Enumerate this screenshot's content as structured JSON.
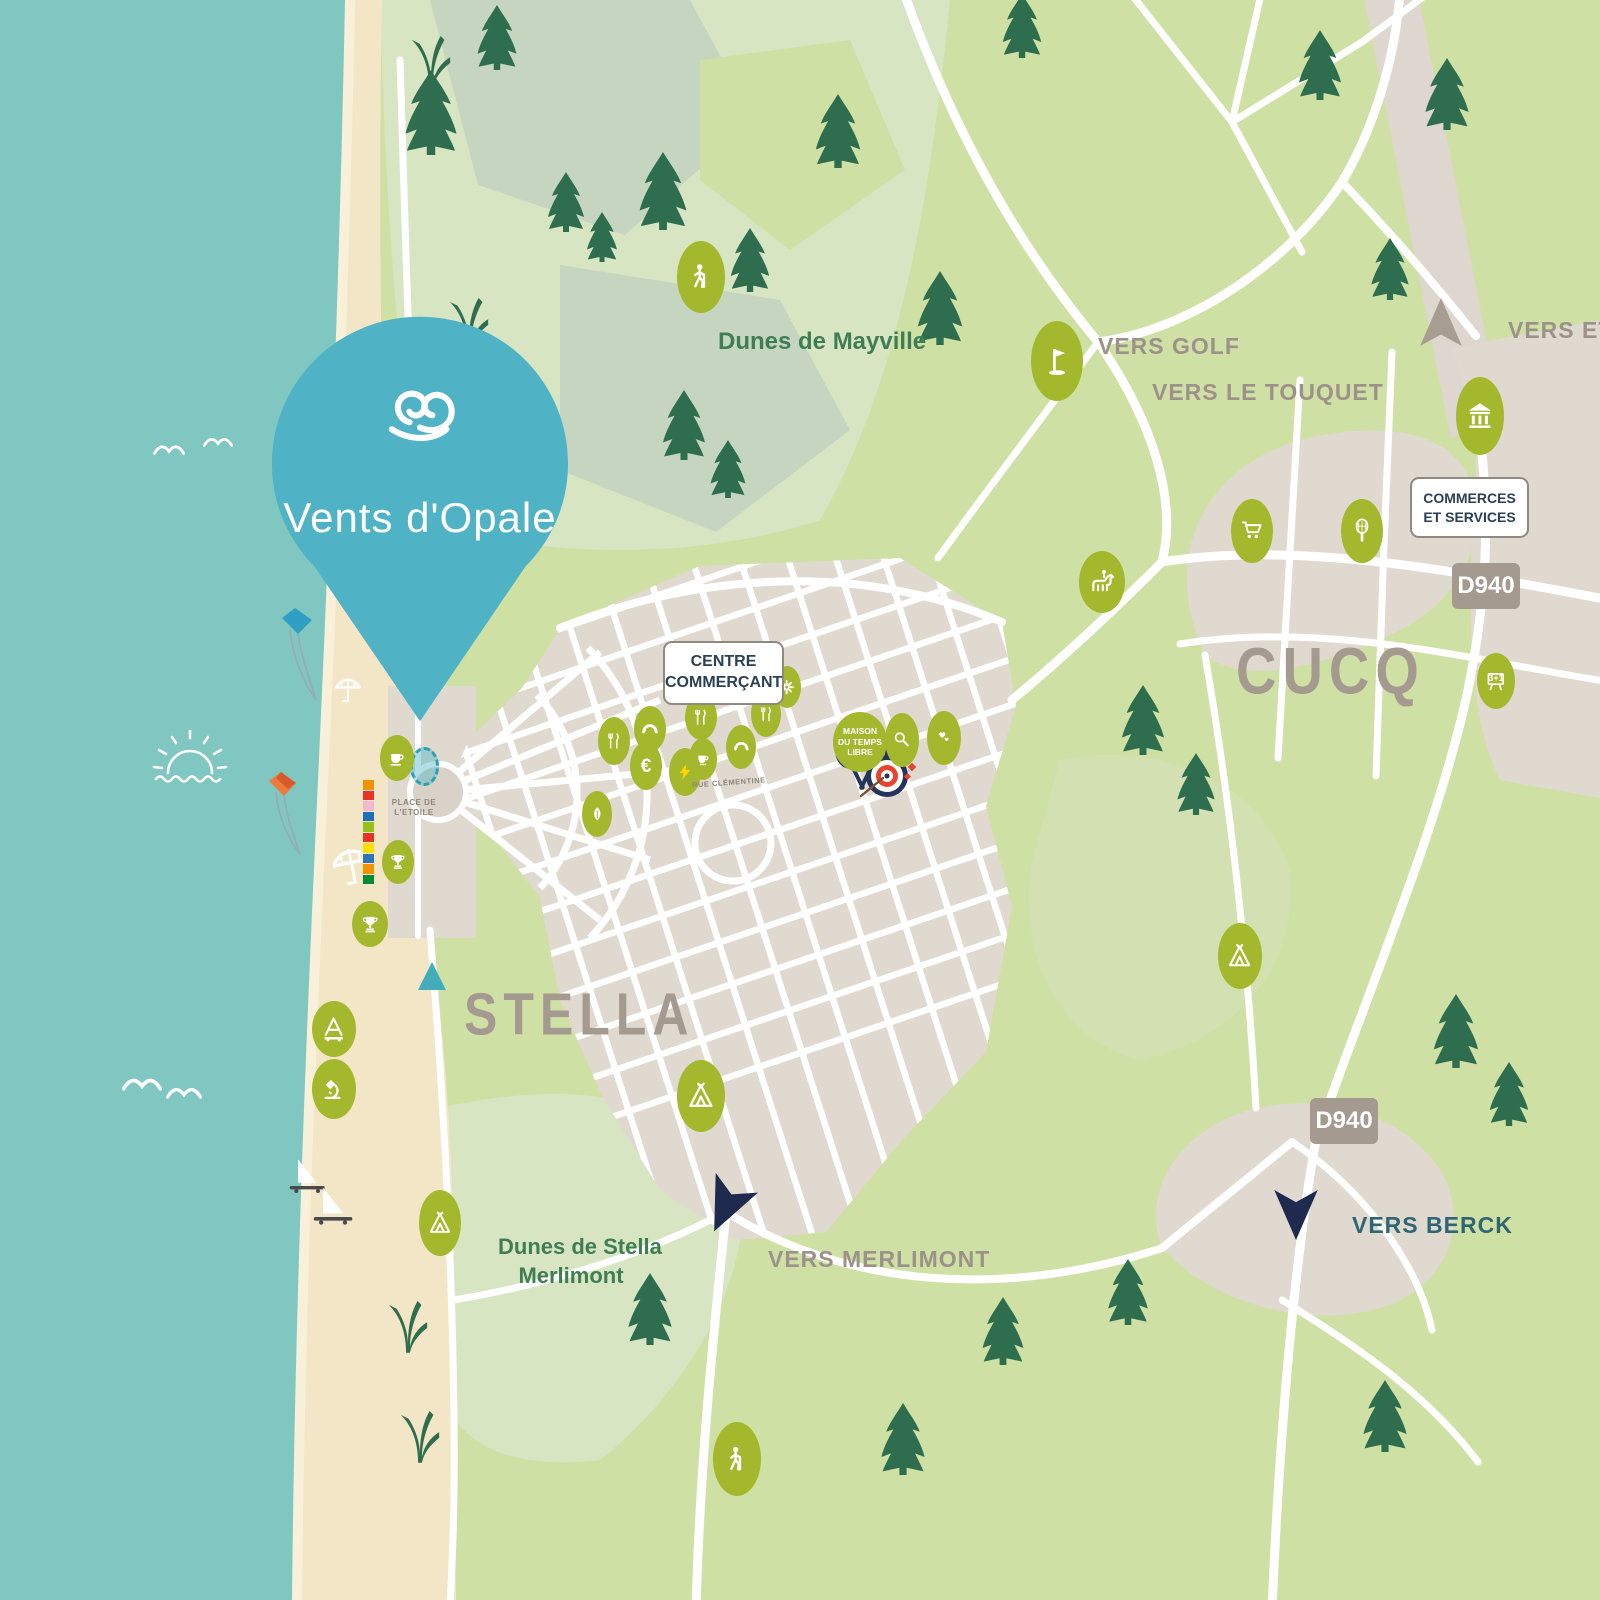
{
  "app": {
    "title": "Vents d'Opale",
    "type": "illustrated-location-map"
  },
  "colors": {
    "sea": "#7fc7c0",
    "sand": "#f3e6c6",
    "land": "#cfe0a5",
    "land_pale": "#d8e5c2",
    "land_sage": "#c5d5c0",
    "urban": "#e0d9d0",
    "road": "#ffffff",
    "olive": "#a3b82d",
    "pine": "#2e6e4e",
    "pin": "#4fb2c5",
    "taupe_text": "#9c928a",
    "navy_text": "#2c4055",
    "green_text": "#3f7d54",
    "teal_text": "#2f6673",
    "road_badge": "#a49a90",
    "arrow_navy": "#1e2b4e"
  },
  "pin": {
    "label": "Vents d'Opale"
  },
  "labels": {
    "cucq": "CUCQ",
    "stella": "STELLA",
    "dunes_mayville": "Dunes de Mayville",
    "dunes_stella_1": "Dunes de Stella",
    "dunes_stella_2": "Merlimont",
    "vers_golf": "VERS GOLF",
    "vers_touquet": "VERS LE TOUQUET",
    "vers_etaples": "VERS ETAPLES",
    "vers_merlimont": "VERS MERLIMONT",
    "vers_berck": "VERS BERCK",
    "centre_1": "CENTRE",
    "centre_2": "COMMERÇANT",
    "commerces_1": "COMMERCES",
    "commerces_2": "ET SERVICES",
    "d940": "D940",
    "maison_1": "MAISON",
    "maison_2": "DU TEMPS",
    "maison_3": "LIBRE",
    "place_etoile_1": "PLACE DE",
    "place_etoile_2": "L'ETOILE",
    "rue_clementine": "RUE CLÉMENTINE"
  },
  "pois": [
    {
      "name": "hiking-poi",
      "icon": "hiker",
      "x": 701,
      "y": 277,
      "w": 48,
      "h": 72
    },
    {
      "name": "golf-poi",
      "icon": "golf",
      "x": 1057,
      "y": 361,
      "w": 52,
      "h": 80
    },
    {
      "name": "monument-poi",
      "icon": "monument",
      "x": 1480,
      "y": 416,
      "w": 48,
      "h": 78
    },
    {
      "name": "supermarket-poi",
      "icon": "cart",
      "x": 1252,
      "y": 531,
      "w": 42,
      "h": 64
    },
    {
      "name": "tennis-poi",
      "icon": "racket",
      "x": 1362,
      "y": 531,
      "w": 42,
      "h": 64
    },
    {
      "name": "equestrian-poi",
      "icon": "horse",
      "x": 1102,
      "y": 582,
      "w": 46,
      "h": 62
    },
    {
      "name": "cafe-poi",
      "icon": "coffee",
      "x": 397,
      "y": 758,
      "w": 34,
      "h": 46
    },
    {
      "name": "club-poi",
      "icon": "trophy",
      "x": 398,
      "y": 862,
      "w": 32,
      "h": 44
    },
    {
      "name": "club-poi",
      "icon": "trophy",
      "x": 370,
      "y": 924,
      "w": 36,
      "h": 46
    },
    {
      "name": "restaurant-poi",
      "icon": "forkknife",
      "x": 614,
      "y": 741,
      "w": 32,
      "h": 48
    },
    {
      "name": "bakery-poi",
      "icon": "croissant",
      "x": 650,
      "y": 729,
      "w": 32,
      "h": 46
    },
    {
      "name": "restaurant-poi",
      "icon": "forkknife",
      "x": 701,
      "y": 717,
      "w": 32,
      "h": 46
    },
    {
      "name": "restaurant-poi",
      "icon": "forkknife",
      "x": 766,
      "y": 714,
      "w": 30,
      "h": 46
    },
    {
      "name": "pharmacy-poi",
      "icon": "flower",
      "x": 787,
      "y": 687,
      "w": 28,
      "h": 42
    },
    {
      "name": "cafe-poi",
      "icon": "coffee",
      "x": 703,
      "y": 759,
      "w": 28,
      "h": 42
    },
    {
      "name": "bakery-poi",
      "icon": "croissant",
      "x": 741,
      "y": 747,
      "w": 30,
      "h": 44
    },
    {
      "name": "market-poi",
      "icon": "euro",
      "glyph": "€",
      "x": 646,
      "y": 766,
      "w": 32,
      "h": 48
    },
    {
      "name": "tabac-poi",
      "icon": "bolt",
      "x": 685,
      "y": 772,
      "w": 32,
      "h": 48
    },
    {
      "name": "park-poi",
      "icon": "leaf",
      "x": 597,
      "y": 814,
      "w": 30,
      "h": 46
    },
    {
      "name": "petanque-poi",
      "icon": "magnifier",
      "x": 902,
      "y": 740,
      "w": 34,
      "h": 54
    },
    {
      "name": "health-poi",
      "icon": "hearts",
      "x": 944,
      "y": 738,
      "w": 34,
      "h": 54
    },
    {
      "name": "camping-poi",
      "icon": "tent",
      "x": 1240,
      "y": 956,
      "w": 44,
      "h": 66
    },
    {
      "name": "camping-poi",
      "icon": "tent",
      "x": 701,
      "y": 1096,
      "w": 48,
      "h": 72
    },
    {
      "name": "sand-yachting-poi",
      "icon": "sandyacht",
      "x": 334,
      "y": 1029,
      "w": 44,
      "h": 56
    },
    {
      "name": "nature-discovery-poi",
      "icon": "microscope",
      "x": 334,
      "y": 1089,
      "w": 44,
      "h": 60
    },
    {
      "name": "camping-poi",
      "icon": "tent",
      "x": 440,
      "y": 1223,
      "w": 42,
      "h": 66
    },
    {
      "name": "hiking-poi",
      "icon": "hiker",
      "x": 737,
      "y": 1459,
      "w": 48,
      "h": 74
    },
    {
      "name": "school-poi",
      "icon": "school",
      "glyph": "3+1",
      "x": 1496,
      "y": 681,
      "w": 38,
      "h": 56
    }
  ],
  "beach_cabins": [
    "#f39200",
    "#e6332a",
    "#f4b8d0",
    "#1d70b7",
    "#95c11f",
    "#e6332a",
    "#ffde00",
    "#2e75b6",
    "#f39200",
    "#008d36"
  ]
}
